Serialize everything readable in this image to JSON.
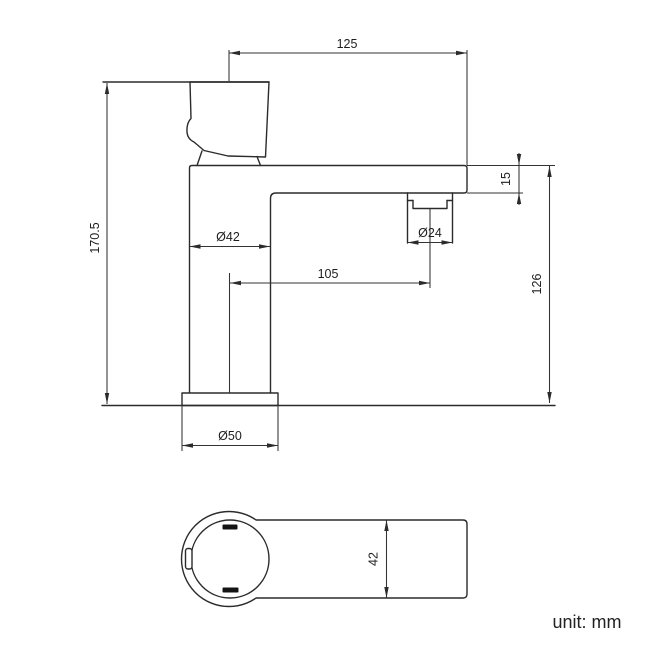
{
  "drawing": {
    "unit_label": "unit: mm",
    "side_view": {
      "dim_top_width": "125",
      "dim_total_height": "170.5",
      "dim_spout_thickness": "15",
      "dim_body_diameter": "Ø42",
      "dim_aerator_diameter": "Ø24",
      "dim_spout_reach": "105",
      "dim_spout_height": "126",
      "dim_base_diameter": "Ø50"
    },
    "top_view": {
      "dim_body_width": "42"
    }
  }
}
